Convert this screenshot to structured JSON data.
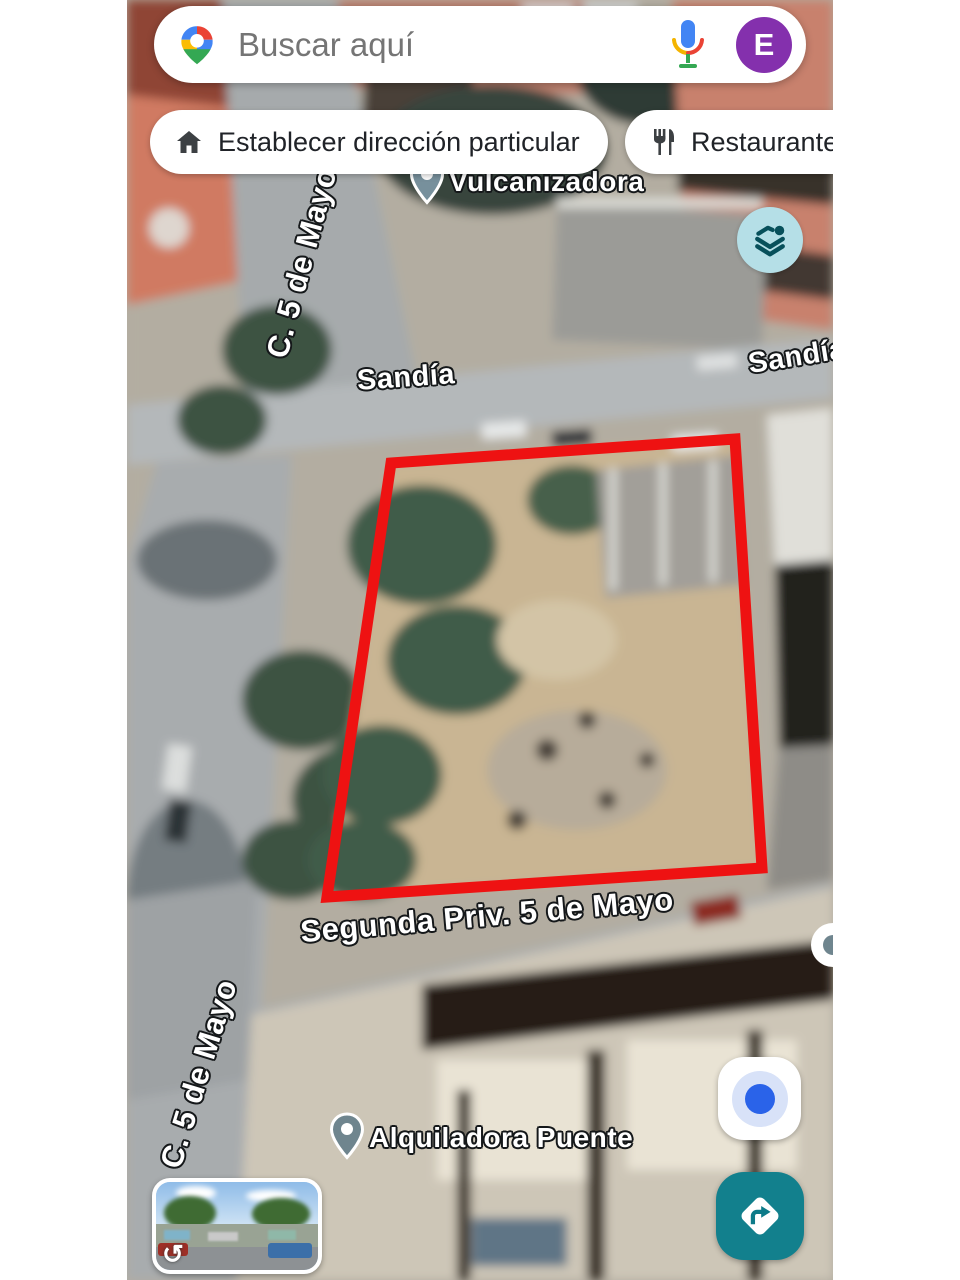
{
  "app": {
    "name": "Google Maps",
    "view": "satellite"
  },
  "search_bar": {
    "placeholder": "Buscar aquí",
    "logo_icon": "google-maps-pin-icon",
    "mic_icon": "voice-search-icon",
    "avatar_letter": "E"
  },
  "chips": [
    {
      "icon": "home-icon",
      "label": "Establecer dirección particular"
    },
    {
      "icon": "restaurant-icon",
      "label": "Restaurantes"
    }
  ],
  "map": {
    "street_labels": [
      {
        "id": "c5-top",
        "text": "C. 5 de Mayo"
      },
      {
        "id": "sandia-left",
        "text": "Sandía"
      },
      {
        "id": "sandia-right",
        "text": "Sandía"
      },
      {
        "id": "segunda-priv",
        "text": "Segunda Priv. 5 de Mayo"
      },
      {
        "id": "c5-bottom",
        "text": "C. 5 de Mayo"
      }
    ],
    "pois": [
      {
        "icon": "map-pin-icon",
        "label": "Vulcanizadora"
      },
      {
        "icon": "map-pin-icon",
        "label": "Alquiladora Puente"
      }
    ],
    "overlay": {
      "name": "property-boundary",
      "color": "#ee1212"
    }
  },
  "buttons": {
    "layers": {
      "icon": "layers-icon",
      "bg": "#b5dfe7"
    },
    "my_location": {
      "icon": "my-location-icon",
      "dot_color": "#2a63e9"
    },
    "directions": {
      "icon": "directions-diamond-icon",
      "bg": "#12808d"
    },
    "street_view_rotate": "↺"
  },
  "colors": {
    "boundary_red": "#ee1212",
    "avatar_purple": "#8430ad",
    "directions_teal": "#12808d",
    "layers_teal_bg": "#b5dfe7",
    "location_blue": "#2a63e9"
  }
}
